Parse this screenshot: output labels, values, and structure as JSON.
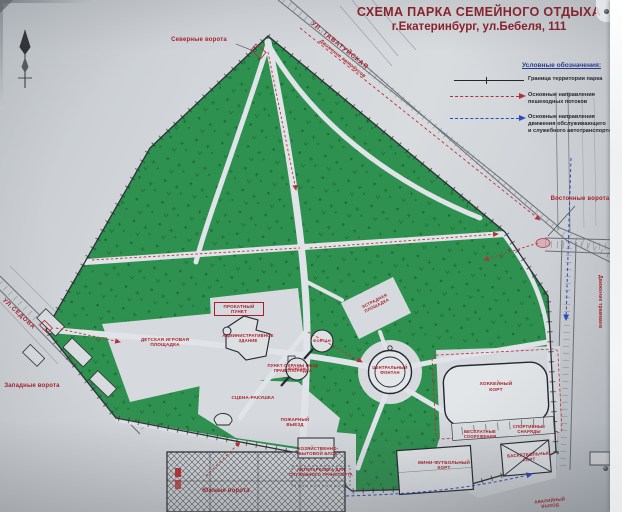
{
  "title": {
    "line1": "СХЕМА ПАРКА СЕМЕЙНОГО ОТДЫХА",
    "line2": "г.Екатеринбург,  ул.Бебеля, 111"
  },
  "legend": {
    "heading": "Условные обозначения:",
    "items": [
      {
        "id": "park-boundary",
        "label": "Граница территории парка"
      },
      {
        "id": "pedestrian-flows",
        "label": "Основные направления\nпешеходных потоков"
      },
      {
        "id": "service-transport",
        "label": "Основные направления\nдвижения обслуживающего\nи служебного автотранспорта"
      }
    ]
  },
  "streets": {
    "tavatuyskaya": "УЛ. ТАВАТУЙСКАЯ",
    "sedova": "УЛ.СЕДОВА",
    "bus_traffic": "Движение автобусов",
    "tram_traffic": "Движение трамваев"
  },
  "gates": {
    "north": "Северные ворота",
    "east": "Восточные ворота",
    "west": "Западные ворота",
    "south": "Южные ворота"
  },
  "facilities": {
    "rental_point": "ПРОКАТНЫЙ\nПУНКТ",
    "admin_building": "АДМИНИСТРАТИВНОЕ\nЗДАНИЕ",
    "playground": "ДЕТСКАЯ ИГРОВАЯ\nПЛОЩАДКА",
    "security_point": "ПУНКТ ОХРАНЫ ОБЩ.\nПРАВОПОРЯДКА",
    "stage_shell": "СЦЕНА-РАКУШКА",
    "fire_exit": "ПОЖАРНЫЙ\nВЫЕЗД",
    "fountain_1": "ФОНТАН",
    "fountain_2": "ФОНТАН",
    "dance_floor": "ЭСТРАДНАЯ\nПЛОЩАДКА",
    "central_fountain": "ЦЕНТРАЛЬНЫЙ\nФОНТАН",
    "hockey_rink": "ХОККЕЙНЫЙ\nКОРТ",
    "free_equipment": "БЕСПЛАТНЫЕ\nСООРУЖЕНИЯ",
    "sports_gear": "СПОРТИВНЫЕ\nСНАРЯДЫ",
    "mini_football": "МИНИ-ФУТБОЛЬНЫЙ\nКОРТ",
    "basketball": "БАСКЕТБОЛЬНЫЙ\nКОРТ",
    "utility_block": "ХОЗЯЙСТВЕННО-\nБЫТОВОЙ БЛОК",
    "parking": "АВТОПАРКОВКА ДЛЯ\nСЛУЖЕБНОГО ТРАНСПОРТА",
    "emergency_exit": "АВАРИЙНЫЙ\nВЫХОД"
  },
  "colors": {
    "park_green": "#2f9150",
    "tree_green": "#186433",
    "label_red": "#a91e28",
    "title_red": "#8e1d27",
    "legend_heading_blue": "#273a93",
    "arrow_red": "#b5303a",
    "arrow_blue": "#2b4bc0",
    "paper": "#d4d8dc"
  }
}
